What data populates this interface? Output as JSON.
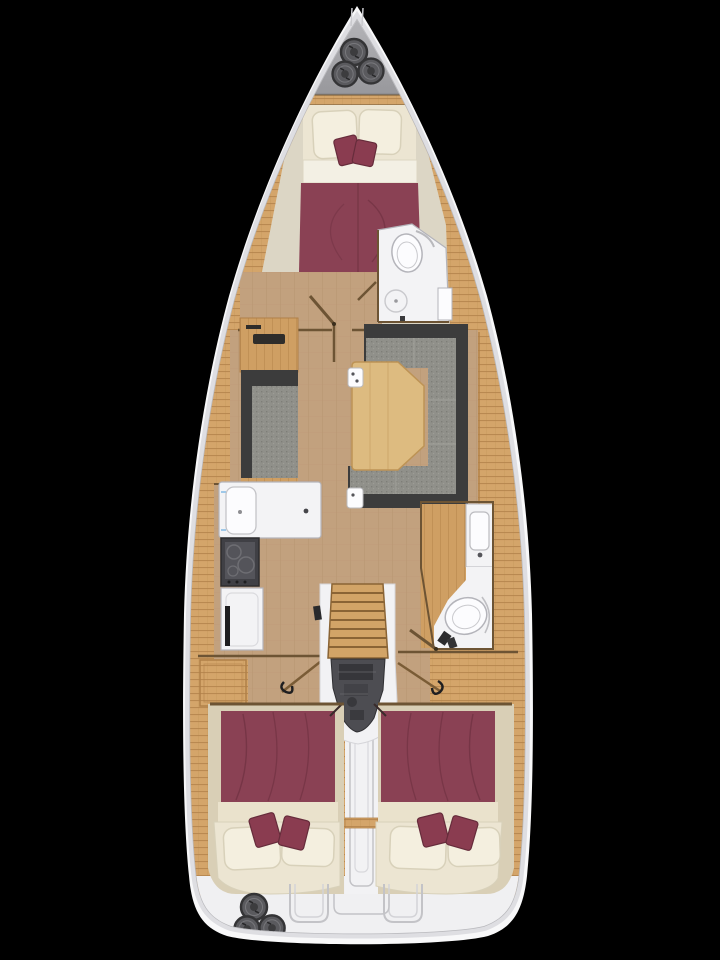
{
  "meta": {
    "title": "Sailing yacht interior deck plan",
    "description": "Top-down rendered floor plan of a sailing yacht hull on black: bow anchor locker with three deck winches, forward owner cabin with double berth and maroon bedding, forward head with toilet and shower, salon with port settee and starboard U-shaped sofa around a wooden table, port galley with sink stove and fridge, starboard aft head with vanity sink and toilet, central companionway stairs over the engine compartment, twin mirrored aft double cabins with maroon bedspreads and cream pillows, stern walkway and transom with three cockpit winches."
  },
  "page": {
    "background": "#000000"
  },
  "colors": {
    "bg": "#000000",
    "hull": "#f8f8f9",
    "hull-shade": "#dedee2",
    "hull-line": "#b9b9bd",
    "bow-panel-light": "#b6b6ba",
    "bow-panel-dark": "#98989c",
    "bow-panel-edge": "#8b8b8f",
    "hatch-fill": "#5a5a5e",
    "hatch-ring": "#343436",
    "hatch-core": "#3c3c3e",
    "deck-wood": "#d4a56a",
    "deck-line": "#b08048",
    "sole-wood": "#c2a17e",
    "sole-line": "#b28f69",
    "wall-wood": "#6d5434",
    "furn-wood": "#cf9f63",
    "table-wood": "#ddbb80",
    "table-line": "#bd9355",
    "sofa-gray": "#90908a",
    "sofa-dot-dark": "#7e7e78",
    "sofa-dot-light": "#9d9d96",
    "sofa-dark": "#3c3c3c",
    "maroon": "#8a4154",
    "maroon-dark": "#703242",
    "maroon-pillow": "#8a3c50",
    "maroon-pillow-edge": "#662c3b",
    "cream-wall": "#dcd6c5",
    "mattress": "#ece5d2",
    "sheet": "#f3f0e4",
    "pillow": "#f4efdf",
    "pillow-edge": "#d8d1ba",
    "room-white": "#f3f3f5",
    "fixture-white": "#fcfcfe",
    "fixture-line": "#b4b4ba",
    "stove-dark": "#404045",
    "stove-panel": "#54545a",
    "engine": "#4d4d52",
    "engine-dark": "#36363a",
    "stair-wood": "#d2a467",
    "stair-line": "#8a6435",
    "frame-tan": "#d9cfb6",
    "band-cream": "#eae2cc",
    "transom": "#f0f0f2",
    "transom-line": "#c3c3c7",
    "corridor-white": "#f2f2f4",
    "handle-dark": "#1e1e20",
    "accent-cyan": "#9fc8e8",
    "rod-wood": "#7a5c36"
  },
  "legend": {
    "regions": [
      {
        "id": "bow-locker",
        "label": "Bow anchor locker with deck winches"
      },
      {
        "id": "forward-cabin",
        "label": "Forward owner cabin, double berth"
      },
      {
        "id": "forward-head",
        "label": "Forward head with toilet and shower"
      },
      {
        "id": "salon",
        "label": "Salon"
      },
      {
        "id": "port-settee",
        "label": "Port settee"
      },
      {
        "id": "u-sofa",
        "label": "Starboard U-shaped sofa"
      },
      {
        "id": "salon-table",
        "label": "Salon table"
      },
      {
        "id": "galley",
        "label": "Port galley: sink, stove, fridge"
      },
      {
        "id": "aft-head",
        "label": "Starboard aft head with vanity and toilet"
      },
      {
        "id": "companionway",
        "label": "Companionway stairs"
      },
      {
        "id": "engine-compartment",
        "label": "Engine compartment"
      },
      {
        "id": "aft-cabin-port",
        "label": "Port aft double cabin"
      },
      {
        "id": "aft-cabin-starboard",
        "label": "Starboard aft double cabin"
      },
      {
        "id": "stern-walkway",
        "label": "Centre walkway between aft cabins"
      },
      {
        "id": "transom",
        "label": "Transom and stern steps"
      },
      {
        "id": "stern-winches",
        "label": "Three stern winches"
      }
    ]
  }
}
